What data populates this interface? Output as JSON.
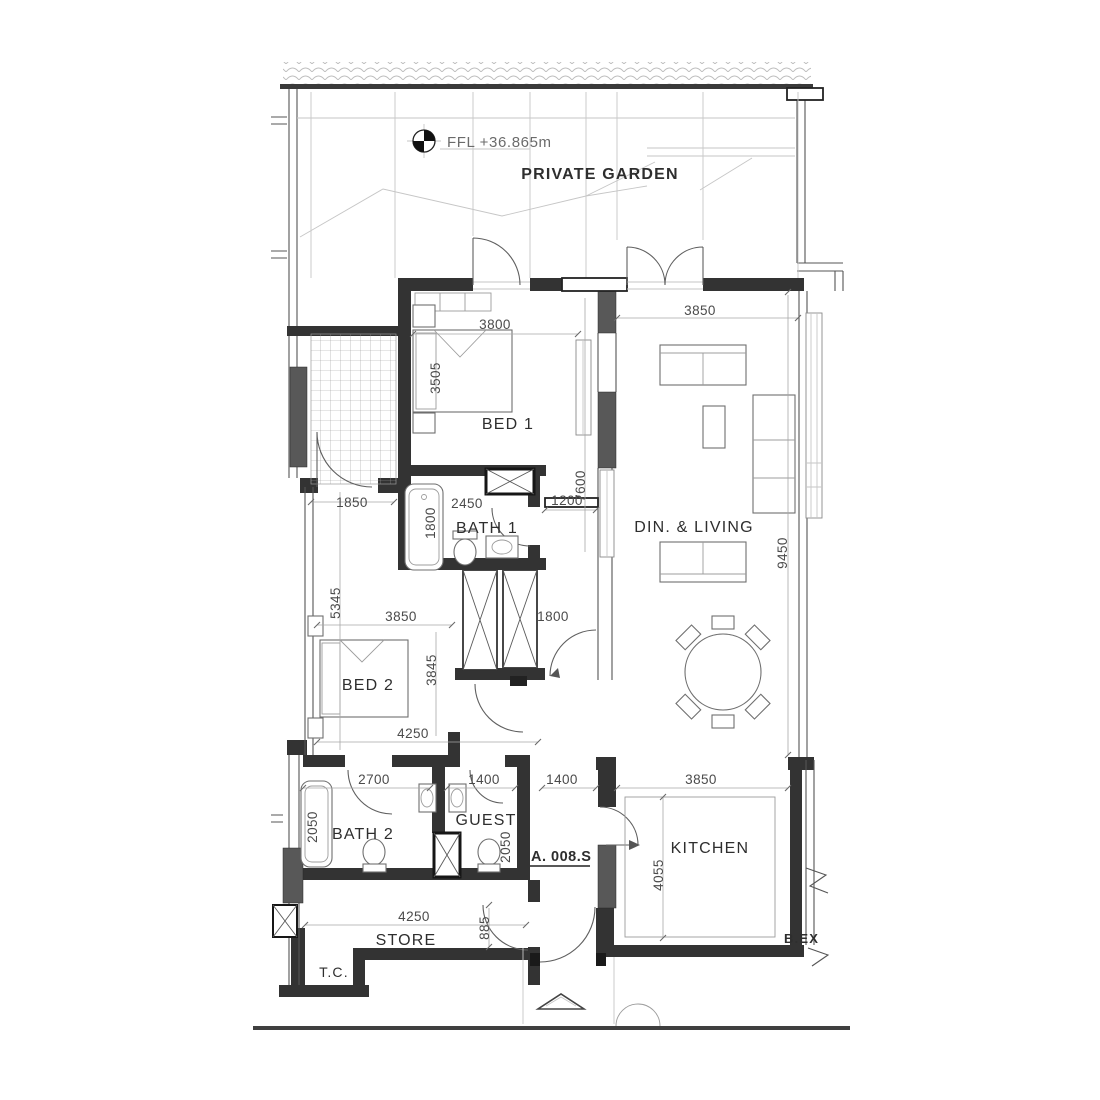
{
  "labels": {
    "ffl": "FFL +36.865m",
    "private_garden": "PRIVATE GARDEN",
    "bed1": "BED 1",
    "bath1": "BATH 1",
    "din_living": "DIN. & LIVING",
    "bed2": "BED 2",
    "bath2": "BATH 2",
    "guest": "GUEST",
    "kitchen": "KITCHEN",
    "store": "STORE",
    "tc": "T.C.",
    "unit_number": "A. 008.S",
    "edge_note": "B.EX"
  },
  "dimensions": {
    "bed1_width": "3800",
    "bed1_length": "3505",
    "terrace_width": "1850",
    "bath1_width": "2450",
    "bath1_depth": "1800",
    "sill_width": "1200",
    "glazing_run": "7600",
    "living_width": "3850",
    "living_length": "9450",
    "bed2_length": "5345",
    "bed2_width": "3850",
    "bed2_depth": "3845",
    "hall_door_width": "1800",
    "bed2_zone_width": "4250",
    "bath2_width": "2700",
    "guest_width": "1400",
    "entry_width": "1400",
    "kitchen_width": "3850",
    "bath2_tub_length": "2050",
    "guest_depth": "2050",
    "kitchen_depth": "4055",
    "store_width": "4250",
    "store_door_width": "885"
  }
}
